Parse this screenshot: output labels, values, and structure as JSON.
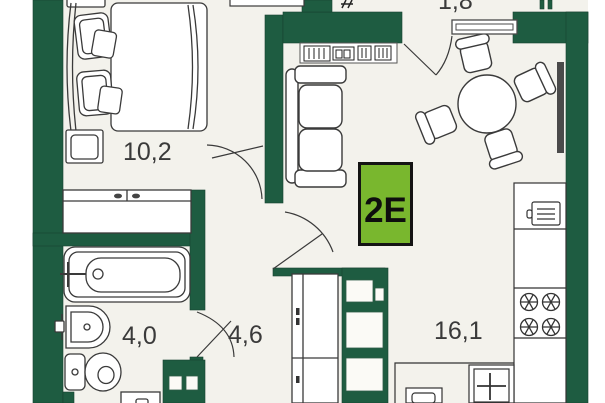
{
  "plan": {
    "unit_label": "2E",
    "rooms": [
      {
        "id": "bedroom",
        "area": "10,2"
      },
      {
        "id": "bathroom",
        "area": "4,0"
      },
      {
        "id": "hallway",
        "area": "4,6"
      },
      {
        "id": "kitchen-living",
        "area": "16,1"
      },
      {
        "id": "balcony",
        "area": "1,8"
      }
    ],
    "colors": {
      "wall": "#1e5c41",
      "floor": "#f3f2ec",
      "badge_bg": "#79b72e",
      "badge_border": "#141414",
      "label_text": "#3a3a3a",
      "furniture_outline": "#3a3a3a",
      "radiator": "#4a4a4a"
    }
  }
}
